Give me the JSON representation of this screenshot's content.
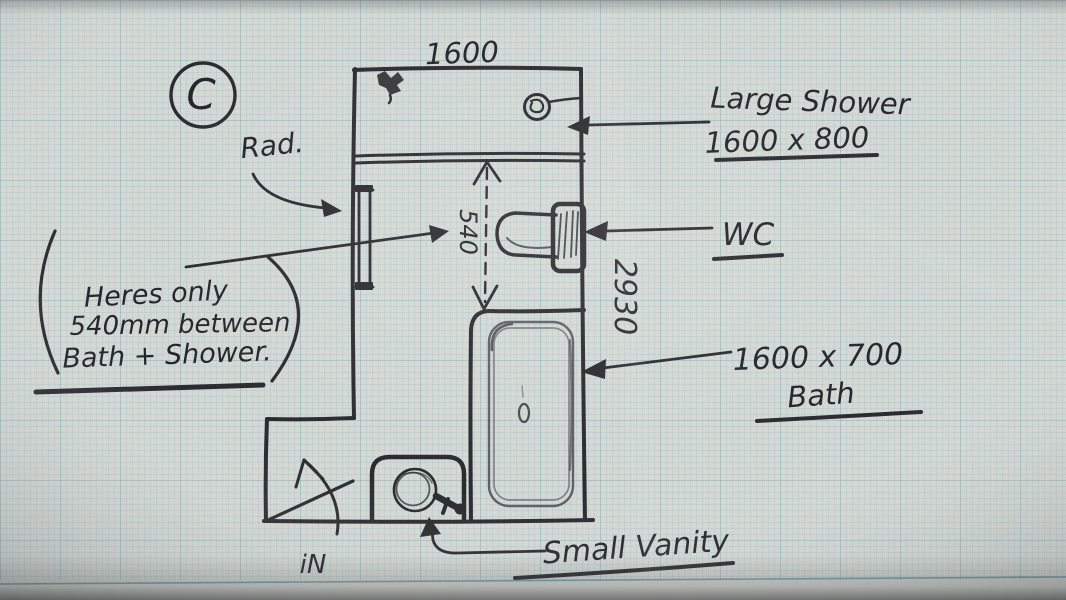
{
  "sketch": {
    "plan_circle_label": "C",
    "dimensions": {
      "top_width": "1600",
      "room_height": "2930",
      "gap_between_bath_and_shower": "540"
    },
    "labels": {
      "radiator": "Rad.",
      "shower_line1": "Large Shower",
      "shower_line2": "1600 x 800",
      "wc": "WC",
      "bath_line1": "1600 x 700",
      "bath_line2": "Bath",
      "vanity": "Small Vanity",
      "entrance": "iN"
    },
    "note": {
      "line1": "Heres only",
      "line2": "540mm between",
      "line3": "Bath + Shower."
    },
    "fixtures": [
      "large shower",
      "radiator",
      "wc",
      "bath",
      "small vanity"
    ],
    "colors": {
      "ink": "#2c2c30",
      "pencil": "#4b4b52",
      "paper": "#d6d8d3",
      "grid_minor": "#7fa9b6",
      "grid_major": "#5e93a2"
    }
  }
}
